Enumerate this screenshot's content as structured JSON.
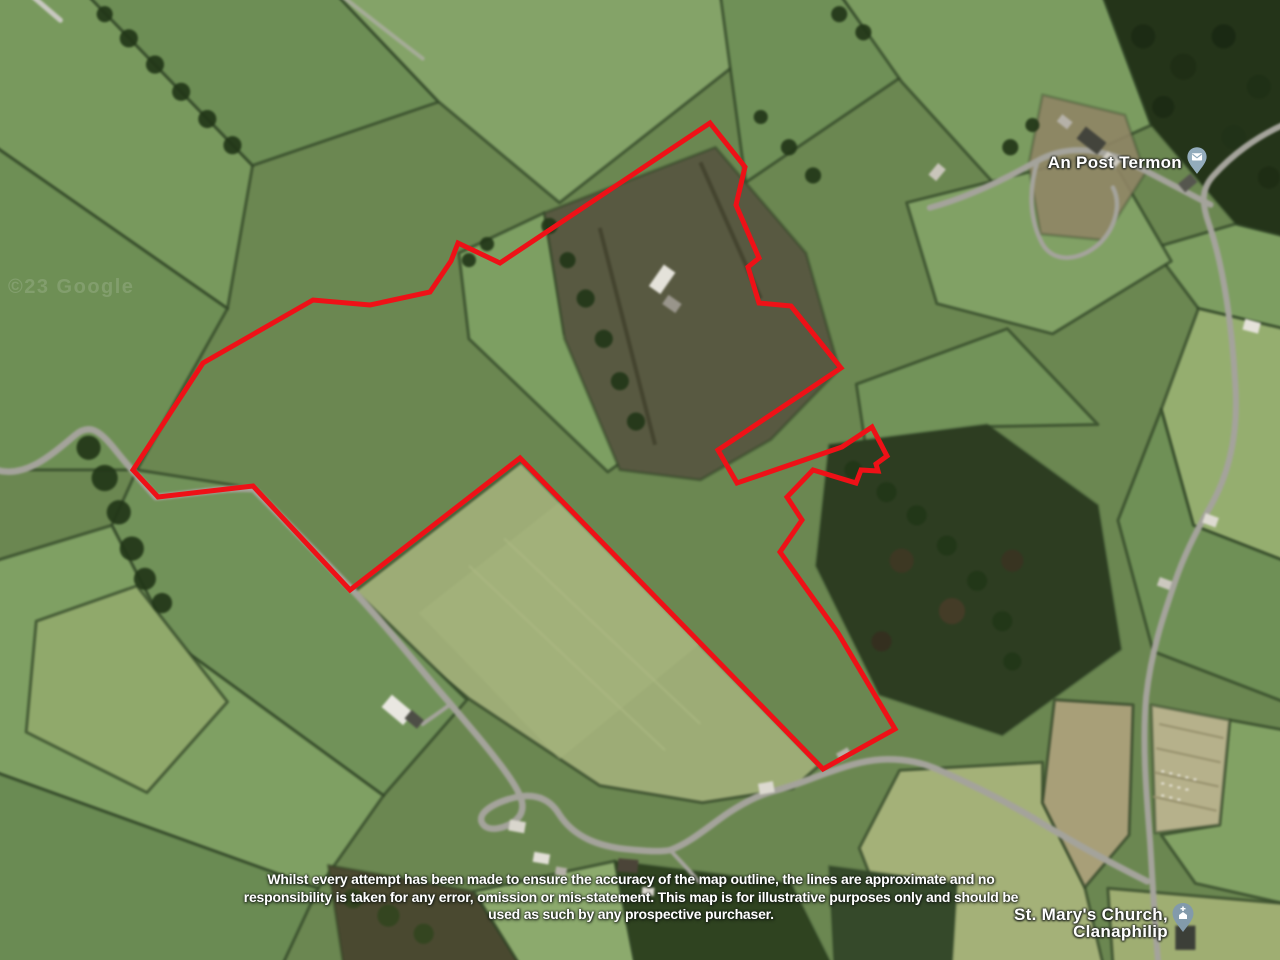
{
  "map": {
    "watermark_text": "©23 Google",
    "boundary": {
      "color": "#ee1117",
      "points": "710,123 745,167 736,205 759,258 748,267 759,303 791,306 841,368 718,450 737,483 842,447 872,427 887,456 876,464 878,471 861,470 856,483 813,470 787,497 802,520 780,552 838,633 895,729 823,769 520,458 350,590 253,486 158,497 133,470 203,363 313,300 370,305 430,292 451,261 458,243 500,263"
    },
    "pins": [
      {
        "id": "post-office",
        "label": "An Post Termon",
        "color": "#93acbc"
      },
      {
        "id": "church",
        "label_line1": "St. Mary's Church,",
        "label_line2": "Clanaphilip",
        "color": "#829aab"
      }
    ],
    "disclaimer": {
      "line1": "Whilst every attempt has been made to ensure the accuracy of the map outline, the lines are approximate and no",
      "line2": "responsibility is taken for any error, omission or mis-statement. This map is for illustrative purposes only and should be",
      "line3": "used as such by any prospective purchaser."
    }
  }
}
